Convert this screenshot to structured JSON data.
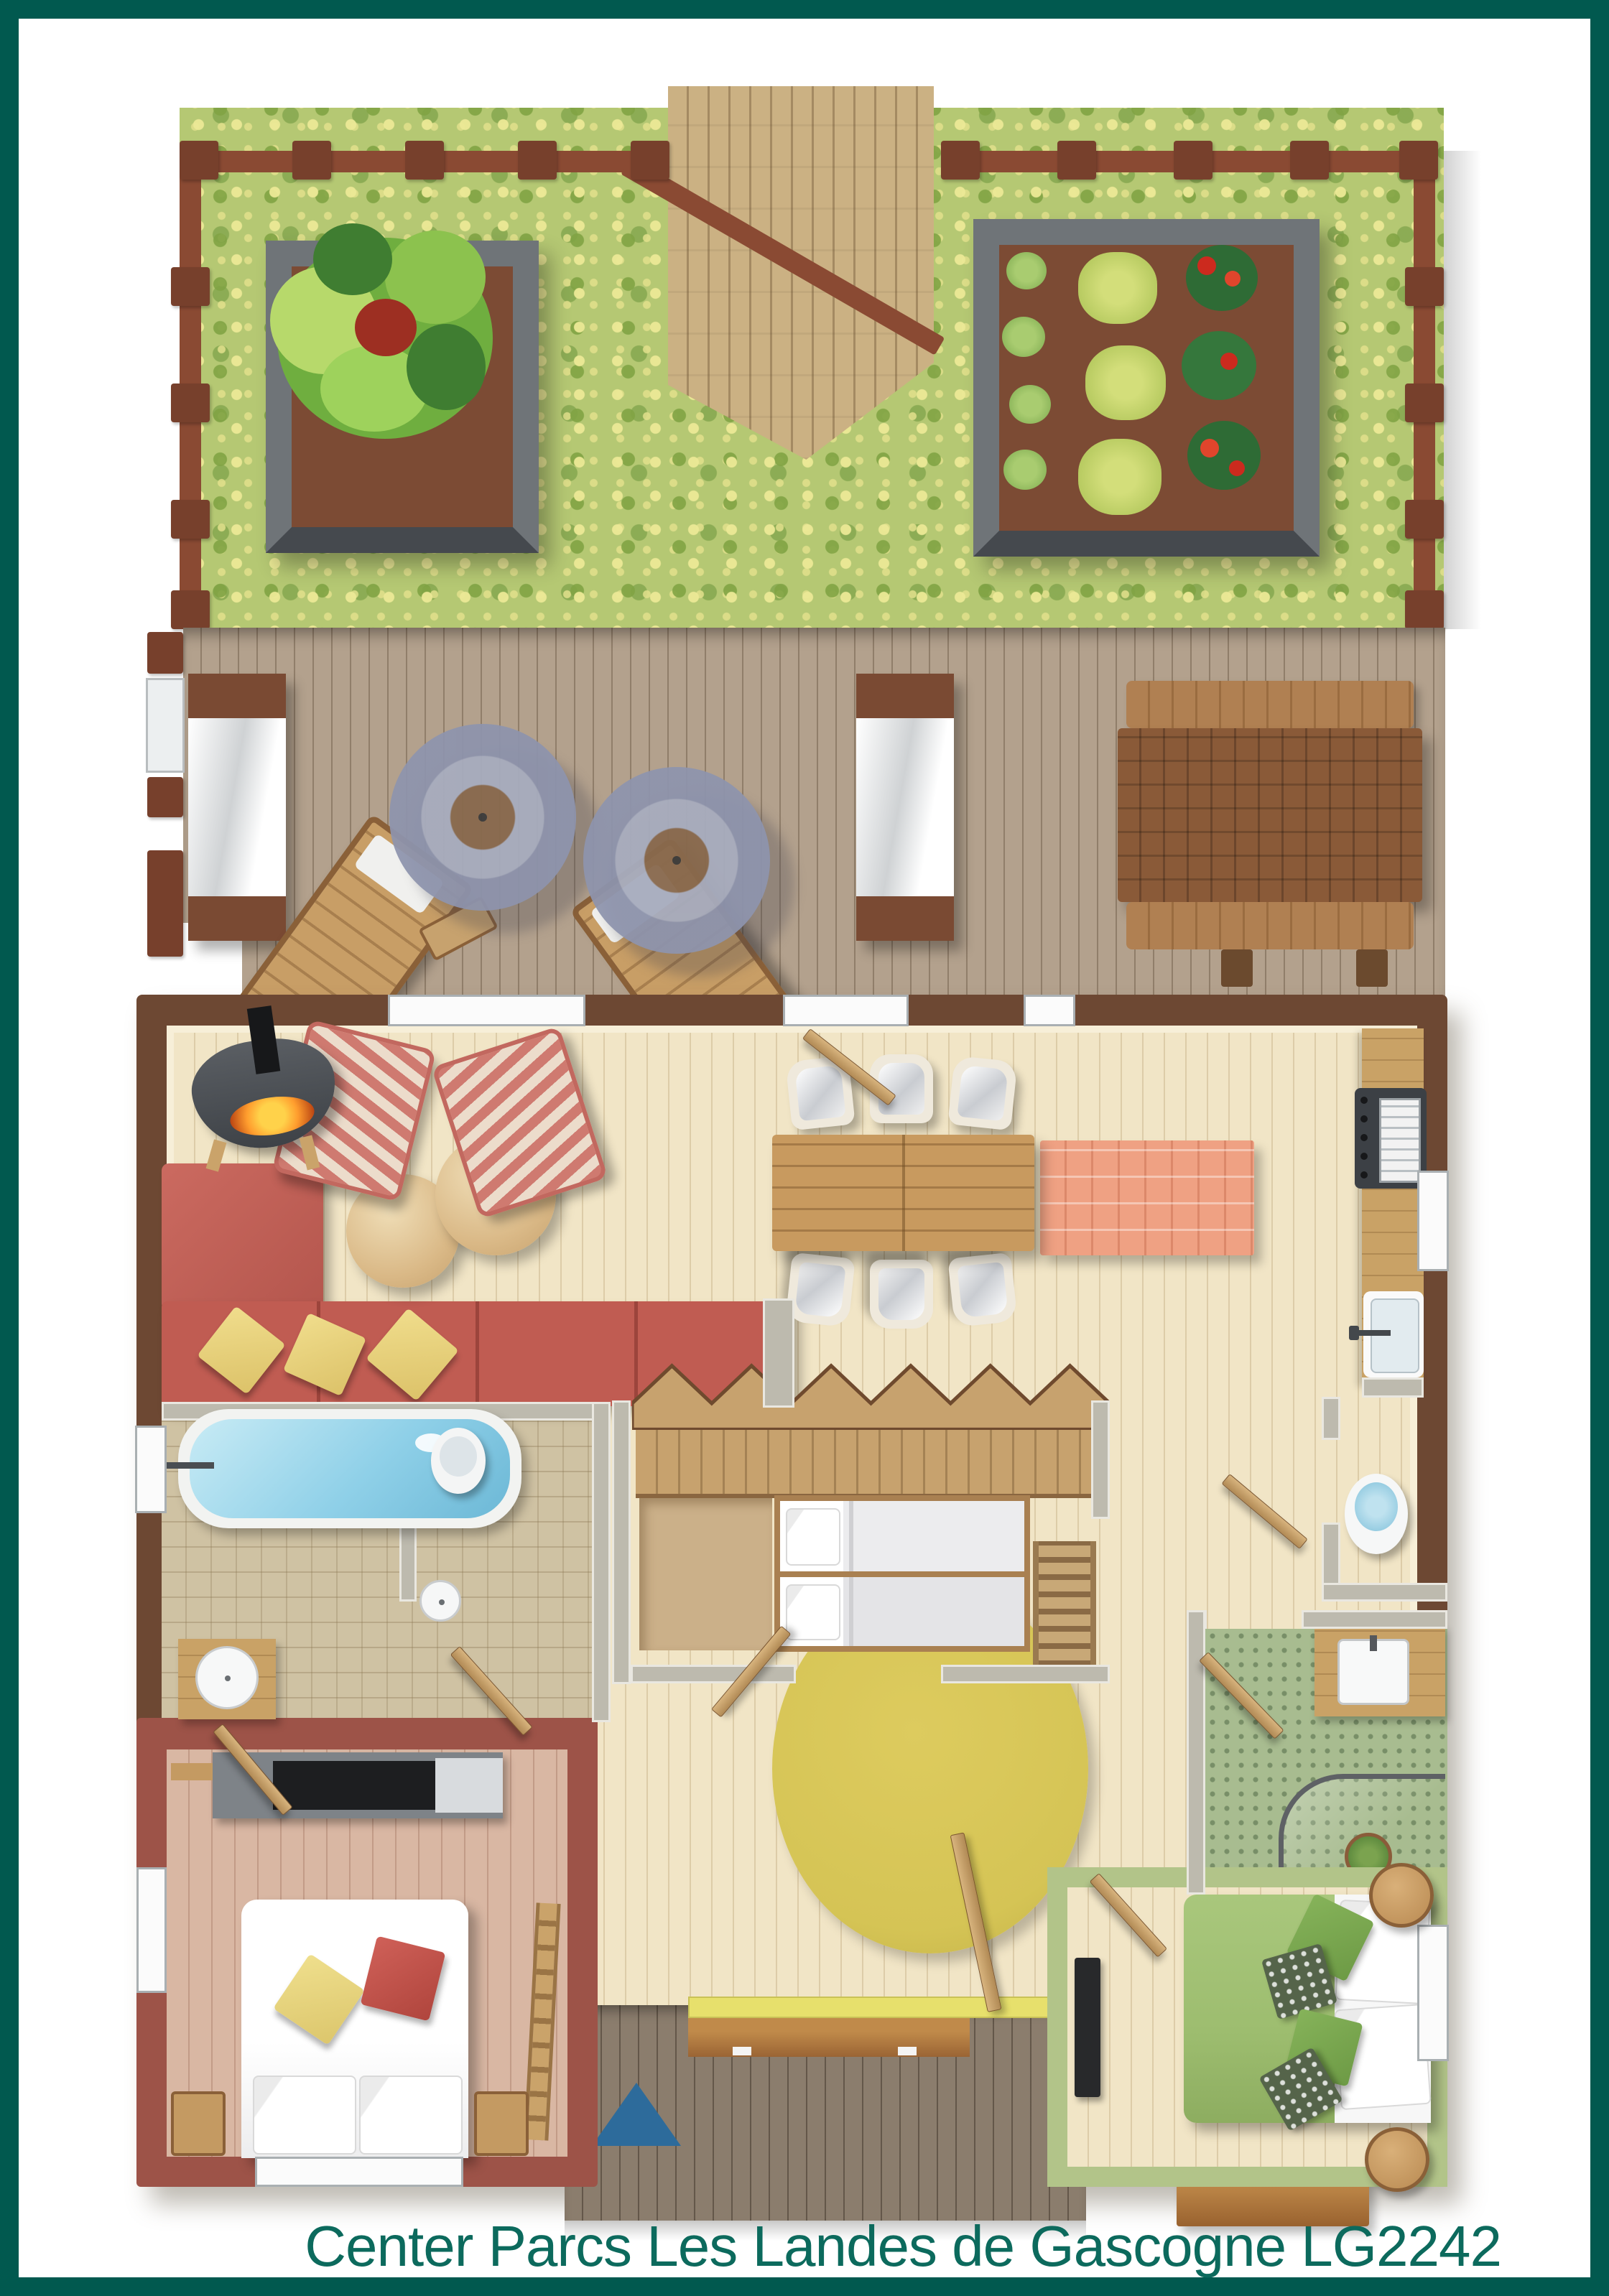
{
  "caption": {
    "text": "Center Parcs Les Landes de Gascogne LG2242"
  },
  "palette": {
    "frame_teal": "#01594f",
    "caption_teal": "#0c6a5d",
    "wall_brown": "#6d4833",
    "wall_maroon": "#9d5348",
    "wall_grey": "#bdbaae",
    "floor_cream": "#f1e5c6",
    "floor_pink": "#d9b7a3",
    "tile_beige": "#cfc2a3",
    "tile_green": "#a8bc90",
    "grass_green": "#b5c873",
    "deck_wood": "#b3a18d",
    "porch_wood": "#8b7d6d",
    "path_wood": "#cbb183",
    "sofa_red": "#c05c52",
    "rug_salmon": "#efa183",
    "rug_yellow": "#d5c455",
    "water_blue": "#8fd0e8",
    "bed_green": "#9dbd6f",
    "accent_wood": "#c9a266",
    "fence_brown": "#8a4a33",
    "fire_orange": "#ff9d2e",
    "mat_blue": "#2d6b9b"
  }
}
